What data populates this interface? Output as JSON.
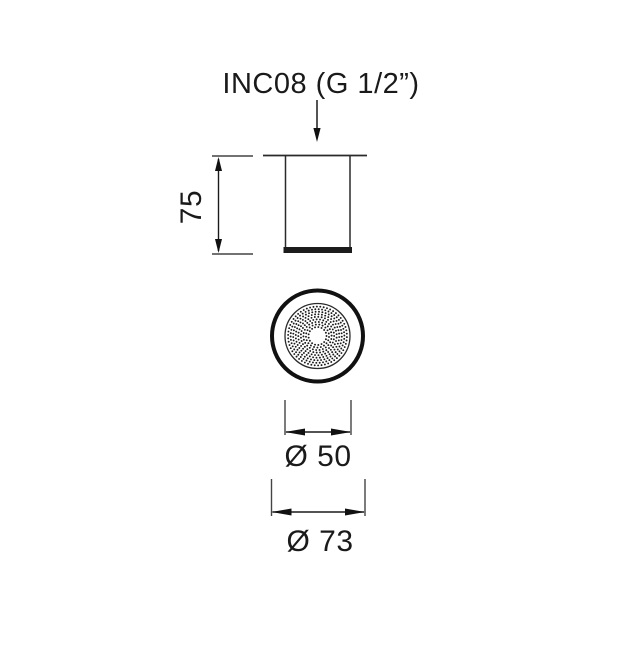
{
  "title": {
    "label": "INC08 (G 1/2”)"
  },
  "side_view": {
    "height_dimension_label": "75"
  },
  "bottom_view": {
    "inner_diameter_label": "Ø 50",
    "outer_diameter_label": "Ø 73"
  },
  "colors": {
    "line": "#2a2a2a",
    "thin_line": "#444444",
    "fill_dark": "#1c1c1c",
    "text": "#1a1a1a",
    "background": "#ffffff"
  },
  "drawing": {
    "spray_face_dot_pattern": {
      "cx": 317.5,
      "cy": 336,
      "ring_start_radius": 9,
      "ring_step": 2.55,
      "ring_count": 9,
      "dot_radius": 0.95,
      "dot_spacing": 3.4
    }
  }
}
